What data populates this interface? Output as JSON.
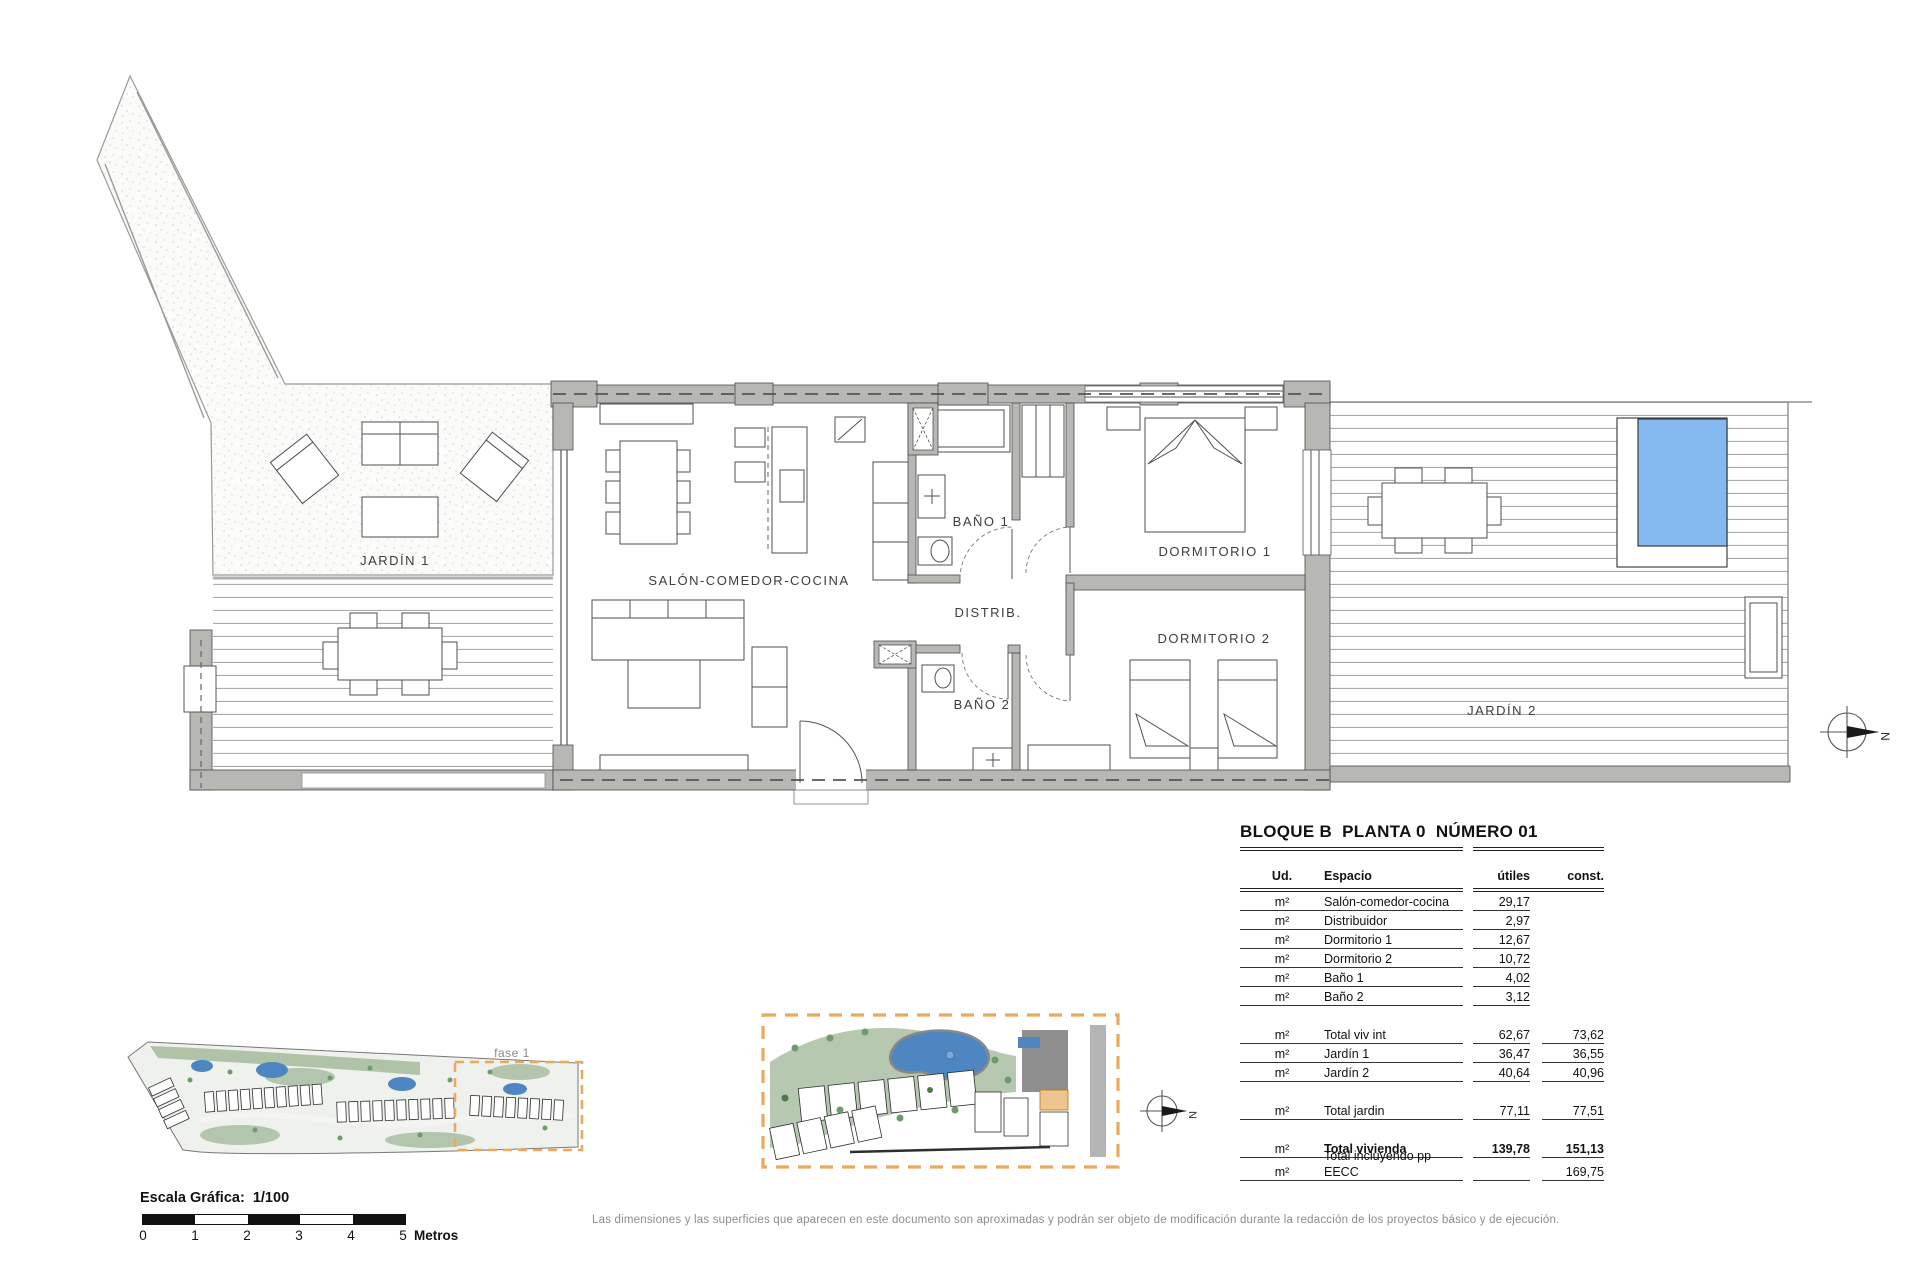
{
  "floorplan": {
    "rooms": {
      "jardin1": "JARDÍN 1",
      "salon": "SALÓN-COMEDOR-COCINA",
      "bano1": "BAÑO 1",
      "distrib": "DISTRIB.",
      "bano2": "BAÑO 2",
      "dormitorio1": "DORMITORIO 1",
      "dormitorio2": "DORMITORIO 2",
      "jardin2": "JARDÍN 2"
    },
    "colors": {
      "pool_water": "#85baf0",
      "wall_gray": "#b7b7b4",
      "phase_dash": "#eaaa5e",
      "site_green": "#a4ba9c",
      "site_pool": "#4d86c0",
      "unit_highlight": "#f0c48e"
    }
  },
  "compass": {
    "north": "N"
  },
  "site_plans": {
    "phase_label": "fase 1"
  },
  "summary_table": {
    "title": "BLOQUE B  PLANTA 0  NÚMERO 01",
    "headers": {
      "ud": "Ud.",
      "espacio": "Espacio",
      "utiles": "útiles",
      "const": "const."
    },
    "rows": [
      {
        "ud": "m²",
        "espacio": "Salón-comedor-cocina",
        "utiles": "29,17",
        "const": ""
      },
      {
        "ud": "m²",
        "espacio": "Distribuidor",
        "utiles": "2,97",
        "const": ""
      },
      {
        "ud": "m²",
        "espacio": "Dormitorio 1",
        "utiles": "12,67",
        "const": ""
      },
      {
        "ud": "m²",
        "espacio": "Dormitorio 2",
        "utiles": "10,72",
        "const": ""
      },
      {
        "ud": "m²",
        "espacio": "Baño 1",
        "utiles": "4,02",
        "const": ""
      },
      {
        "ud": "m²",
        "espacio": "Baño 2",
        "utiles": "3,12",
        "const": ""
      },
      {
        "ud": "m²",
        "espacio": "Total viv int",
        "utiles": "62,67",
        "const": "73,62"
      },
      {
        "ud": "m²",
        "espacio": "Jardín 1",
        "utiles": "36,47",
        "const": "36,55"
      },
      {
        "ud": "m²",
        "espacio": "Jardín 2",
        "utiles": "40,64",
        "const": "40,96"
      },
      {
        "ud": "m²",
        "espacio": "Total jardin",
        "utiles": "77,11",
        "const": "77,51"
      },
      {
        "ud": "m²",
        "espacio": "Total vivienda",
        "utiles": "139,78",
        "const": "151,13"
      },
      {
        "ud": "m²",
        "espacio": "Total incluyendo pp EECC",
        "utiles": "",
        "const": "169,75"
      }
    ]
  },
  "scalebar": {
    "label": "Escala Gráfica:  1/100",
    "ticks": [
      "0",
      "1",
      "2",
      "3",
      "4",
      "5"
    ],
    "unit": "Metros"
  },
  "disclaimer": "Las dimensiones y las superficies que aparecen en este documento son aproximadas y podrán ser objeto de modificación durante la redacción de los proyectos básico y de ejecución."
}
